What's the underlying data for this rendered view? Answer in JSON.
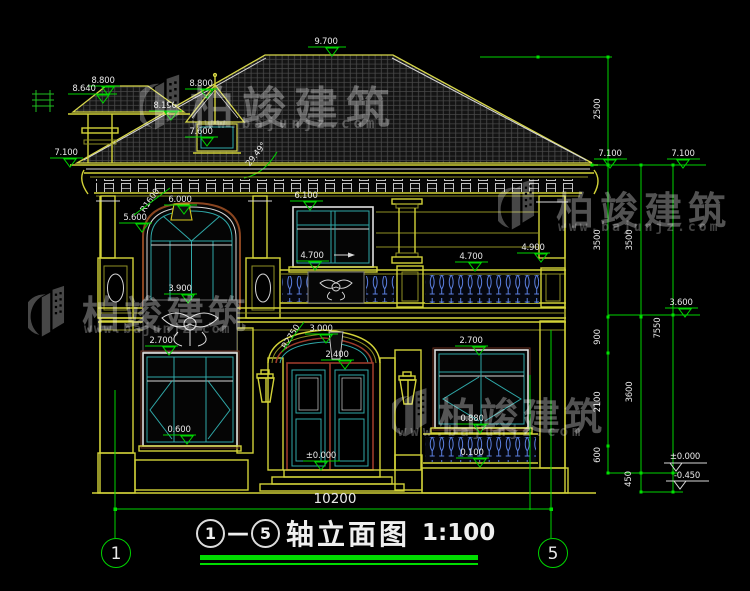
{
  "watermark": {
    "brand": "柏竣建筑",
    "url": "www.bajunjz.com"
  },
  "title": {
    "axis_start": "1",
    "dash": "—",
    "axis_end": "5",
    "name": "轴立面图",
    "scale": "1:100"
  },
  "axes": {
    "left": "1",
    "right": "5"
  },
  "dims": {
    "total_width": "10200",
    "vertical": [
      "2500",
      "3500",
      "3500",
      "900",
      "7550",
      "2100",
      "3600",
      "600",
      "450"
    ]
  },
  "levels": [
    "9.700",
    "8.800",
    "8.640",
    "8.800",
    "8.190",
    "7.600",
    "7.100",
    "6.000",
    "6.100",
    "5.600",
    "3.900",
    "4.700",
    "4.700",
    "4.900",
    "3.000",
    "2.400",
    "2.700",
    "2.700",
    "0.600",
    "0.880",
    "0.100",
    "±0.000",
    "7.100",
    "7.100",
    "3.600",
    "±0.000",
    "-0.450"
  ],
  "annotations": {
    "angle": "29.49°",
    "radius_arch": "R1600",
    "radius_door": "R2750"
  },
  "colors": {
    "dim_green": "#00d400",
    "cad_yellow": "#d2d238",
    "glazing_teal": "#2fa8a8",
    "door_maroon": "#9a3a2a",
    "baluster_blue": "#5b7fe0"
  }
}
